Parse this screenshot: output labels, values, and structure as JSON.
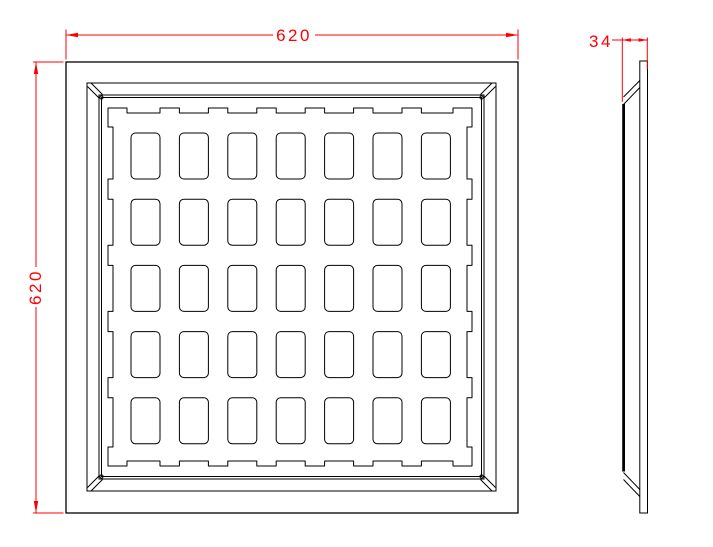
{
  "drawing": {
    "type": "cad-technical-drawing",
    "background_color": "#ffffff",
    "line_color": "#000000",
    "dimension_color": "#ff0000",
    "front_view": {
      "description": "square panel frame with waffle grid tray",
      "grid": {
        "columns": 7,
        "rows": 5
      },
      "dimensions": {
        "width": "620",
        "height": "620"
      }
    },
    "side_view": {
      "description": "panel edge profile with chamfered corners",
      "dimensions": {
        "thickness": "34"
      }
    }
  }
}
